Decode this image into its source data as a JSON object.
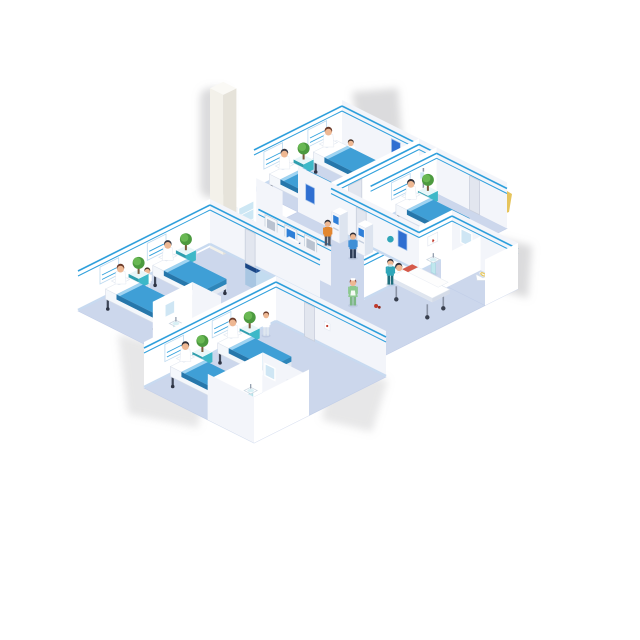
{
  "scene": {
    "type": "isometric-illustration",
    "subject": "hospital ward floor with patient rooms, reception and corridor",
    "background": "#ffffff"
  },
  "palette": {
    "floor": "#ccd7ec",
    "wallU": "#ffffff",
    "wallW": "#f3f5fa",
    "trim": "#2e9fdc",
    "baseboard": "#c8daf0",
    "blanketTop": "#3f9fd6",
    "blanketSide": "#2677ab",
    "blanketFold": "#9fd4f2",
    "sheet": "#ffffff",
    "frame": "#3e4657",
    "standTeal": "#3db8c8",
    "standTealDark": "#2f9fae",
    "plant": "#4c9a3f",
    "plantLight": "#69b853",
    "deskBand": "#1d4f94",
    "deskPanel": "#c3dcf0",
    "deskBase": "#16407e",
    "screenBlue": "#2e7fd8",
    "posterBlue": "#2f6fd1",
    "door": "#e2e6ef",
    "skin": "#eeb893",
    "yellow": "#e6c45c",
    "artifactGray": "#a9aaad",
    "column": "#f3f1ea",
    "glass": "#cde7f4",
    "scrubs": "#2fa6b8",
    "greenDress": "#8cc98f",
    "orangeShirt": "#e2862f",
    "navyCoat": "#2e4468",
    "auburnHair": "#8a3d2e",
    "redAccent": "#c0392b",
    "gurneyPatientTop": "#d65a4a"
  },
  "rooms": [
    {
      "id": "ward-top-right",
      "beds": 2,
      "patients": 2,
      "staff": 1,
      "furniture": [
        "bedside-stand",
        "plant",
        "headboard-panels",
        "door"
      ]
    },
    {
      "id": "ward-far-right",
      "beds": 1,
      "patients": 1,
      "staff": 1,
      "furniture": [
        "bedside-stand",
        "plant",
        "iv-stand",
        "headboard-panel"
      ]
    },
    {
      "id": "bathroom-right",
      "fixtures": [
        "sink",
        "mirror",
        "toilet",
        "first-aid-frame"
      ]
    },
    {
      "id": "ward-left",
      "beds": 2,
      "patients": 2,
      "staff": 1,
      "furniture": [
        "bedside-stands",
        "plants",
        "headboard-panels",
        "door"
      ]
    },
    {
      "id": "bathroom-left",
      "fixtures": [
        "sink",
        "mirror",
        "toilet"
      ]
    },
    {
      "id": "ward-bottom",
      "beds": 2,
      "patients": 2,
      "staff": 1,
      "furniture": [
        "bedside-stands",
        "plants",
        "headboard-panels",
        "door"
      ]
    },
    {
      "id": "bathroom-bottom",
      "fixtures": [
        "sink",
        "mirror",
        "toilet",
        "first-aid-frame"
      ]
    }
  ],
  "reception": {
    "counter": 1,
    "staff": 1,
    "wall_monitors": 3,
    "self_service_kiosks": 2,
    "supply_cabinet": 1,
    "column": 1
  },
  "corridor": {
    "people": [
      "visitor-at-kiosk-orange",
      "visitor-at-kiosk-blue",
      "visitor-with-bag",
      "male-nurse-walking",
      "nurse-in-green-walking",
      "nurse-pushing-gurney",
      "patient-on-gurney"
    ],
    "equipment": [
      "gurney",
      "dropped-red-item"
    ]
  },
  "totals": {
    "beds": 7,
    "gurneys": 1,
    "people": 16,
    "plants": 6,
    "sinks": 3,
    "toilets": 3,
    "doors": 5,
    "posters": 3,
    "monitors": 3
  }
}
